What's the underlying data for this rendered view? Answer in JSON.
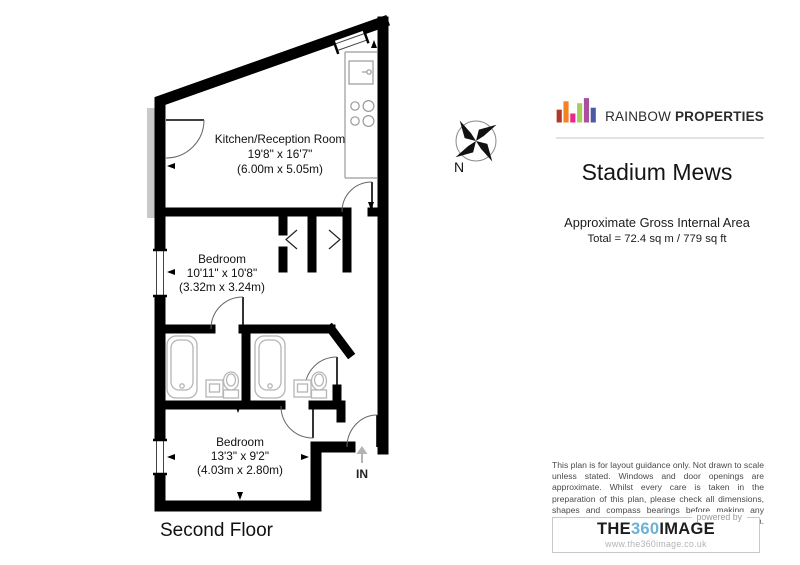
{
  "plan": {
    "floor_label": "Second Floor",
    "entrance_label": "IN",
    "compass_label": "N",
    "rooms": [
      {
        "name": "Kitchen/Reception Room",
        "imperial": "19'8\" x 16'7\"",
        "metric": "(6.00m x 5.05m)"
      },
      {
        "name": "Bedroom",
        "imperial": "10'11\" x 10'8\"",
        "metric": "(3.32m x 3.24m)"
      },
      {
        "name": "Bedroom",
        "imperial": "13'3\" x 9'2\"",
        "metric": "(4.03m x 2.80m)"
      }
    ]
  },
  "branding": {
    "name_regular": "RAINBOW",
    "name_bold": "PROPERTIES",
    "bar_colors": [
      "#b0392b",
      "#f5821f",
      "#ec268c",
      "#a8ce5b",
      "#a9519e",
      "#4d58a7"
    ]
  },
  "property": {
    "title": "Stadium Mews",
    "area_heading": "Approximate Gross Internal Area",
    "area_total": "Total = 72.4 sq m / 779 sq ft"
  },
  "disclaimer": "This plan is for layout guidance only. Not drawn to scale unless stated. Windows and door openings are approximate. Whilst every care is taken in the preparation of this plan, please check all dimensions, shapes and compass bearings before making any decisions reliant upon them.",
  "provider": {
    "powered_by_label": "powered by",
    "brand_part_the": "THE",
    "brand_part_360": "360",
    "brand_part_image": "IMAGE",
    "website": "www.the360image.co.uk",
    "accent_color": "#6db0d4"
  }
}
